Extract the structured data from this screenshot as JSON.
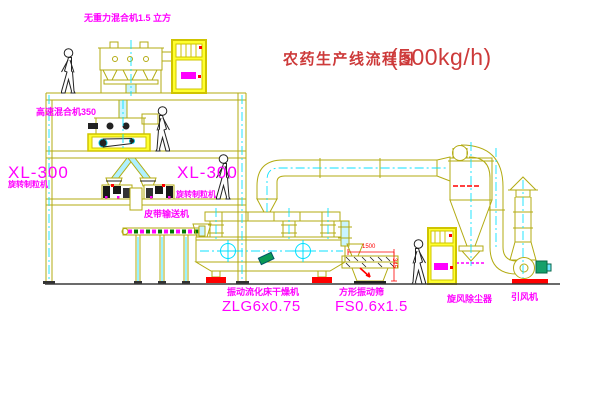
{
  "title": {
    "text": "农药生产线流程图",
    "capacity": "(500kg/h)"
  },
  "equipment_labels": {
    "gravity_free_mixer": "无重力混合机1.5 立方",
    "high_speed_mixer": "高速混合机350",
    "granulator_left_model": "XL-300",
    "granulator_left_name": "旋转制粒机",
    "granulator_right_model": "XL-300",
    "granulator_right_name": "旋转制粒机",
    "belt_conveyor": "皮带输送机",
    "fluid_bed_dryer_name": "振动流化床干燥机",
    "fluid_bed_dryer_model": "ZLG6x0.75",
    "vibrating_screen_name": "方形振动筛",
    "vibrating_screen_model": "FS0.6x1.5",
    "cyclone_dust_collector": "旋风除尘器",
    "induced_draft_fan": "引风机"
  },
  "dimensions": {
    "screen_width": "1500",
    "screen_height": "345"
  },
  "colors": {
    "linework": "#b3ab12",
    "centerline": "#00e0ff",
    "label": "#ff00ff",
    "accent": "#ff0000",
    "title": "#cd3a3a",
    "cabinet_fill": "#ffff2e"
  }
}
